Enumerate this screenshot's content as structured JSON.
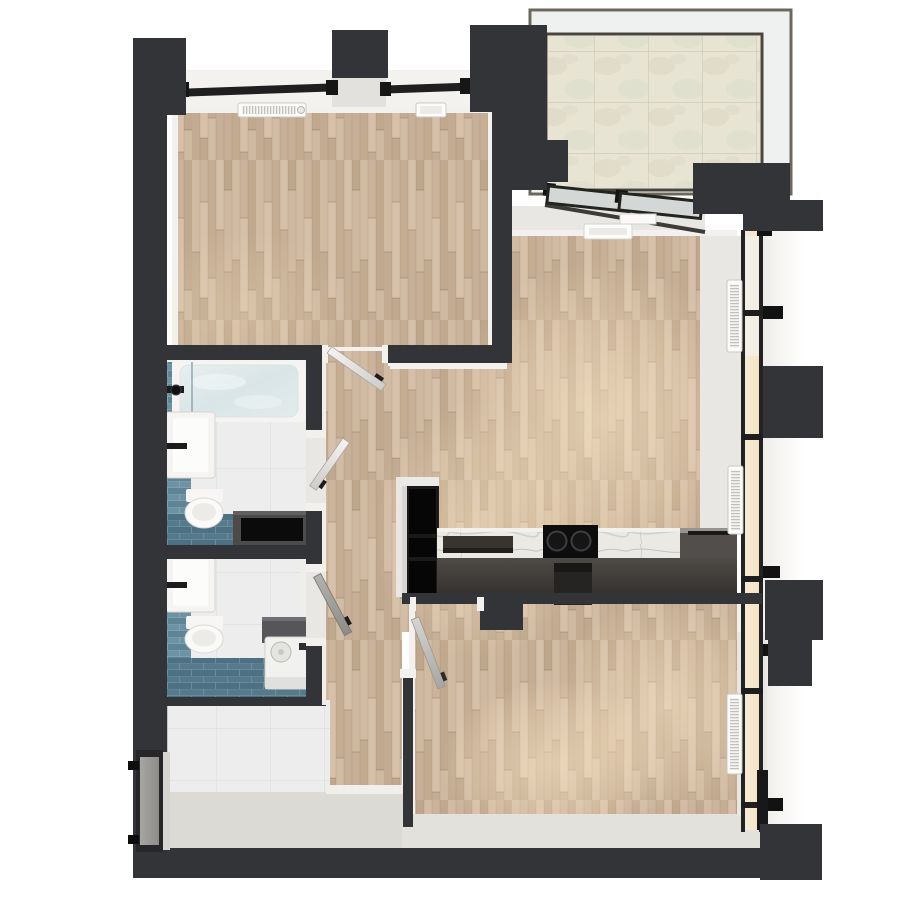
{
  "scene": {
    "kind": "apartment-floor-plan-3d-render",
    "view": "top-down",
    "background": "#ffffff"
  },
  "palette": {
    "background": "#ffffff",
    "wall_dark": "#333437",
    "wall_darker": "#27272a",
    "wood_base": "#c9b29a",
    "trim_white": "#f2f1ee",
    "sill_light": "#e9e7e3",
    "sill_bright": "#f3f2ef",
    "band_light": "#dcdad5",
    "stone_tile": "#e7e4d4",
    "stone_grout": "#cbc8b5",
    "white_tile": "#ecedec",
    "tile_grout": "#dcdedd",
    "blue_tile_wall": "#688ea0",
    "blue_tile_floor": "#53768a",
    "water_blue": "#dfe9e9",
    "fixture_white": "#f5f4f2",
    "fixture_black": "#0b0b0b",
    "bench_gray": "#4c4b49",
    "cabinet_black": "#1a1a1b",
    "counter_right": "#514e4b",
    "cooktop_black": "#0d0d0e",
    "marble_white": "#ebe9e4",
    "door_gray": "#a9a7a4",
    "glass_warm": "#f5e8cf",
    "glass_cool": "#edefef",
    "frame_olive": "#6b675c",
    "frame_dark": "#49453b",
    "radiator_white": "#fcfcfb",
    "sun_glow": "#ffedca",
    "washer_gray": "#55555a",
    "entry_frame": "#27272a"
  },
  "regions": {
    "bedroom": {
      "floor": "wood-parquet",
      "features": [
        "window-bays",
        "radiators"
      ]
    },
    "balcony": {
      "floor": "stone-tile",
      "features": [
        "glass-railing",
        "sliding-doors"
      ]
    },
    "living_kitchen": {
      "floor": "wood-parquet",
      "features": [
        "glass-facade",
        "radiators",
        "kitchen-island"
      ]
    },
    "bathroom_main": {
      "floor": "white-tile",
      "accent": "blue-tile",
      "fixtures": [
        "bathtub",
        "vanity-sink",
        "wall-hung-toilet",
        "storage-bench"
      ]
    },
    "bathroom_second": {
      "floor": "white-tile",
      "accent": "blue-tile",
      "fixtures": [
        "vanity-sink",
        "wall-hung-toilet",
        "washing-machine"
      ]
    },
    "entry_hall": {
      "floor": "white-tile",
      "fixtures": [
        "entry-door"
      ]
    },
    "bottom_room": {
      "floor": "wood-parquet",
      "features": [
        "glass-facade",
        "radiator"
      ]
    },
    "kitchen": {
      "fixtures": [
        "tall-cabinet",
        "marble-counter",
        "cooktop",
        "sink-block"
      ]
    }
  },
  "textures": {
    "wood_plank_shades": [
      "#d1bba3",
      "#c2ab92",
      "#d7c1aa",
      "#bfa88e",
      "#c5ad94",
      "#d5bfa8",
      "#cfb8a0",
      "#c0a88f"
    ],
    "stone_mottle_shades": [
      "#ddd9c5",
      "#d9dcc6",
      "#dedbca"
    ]
  }
}
